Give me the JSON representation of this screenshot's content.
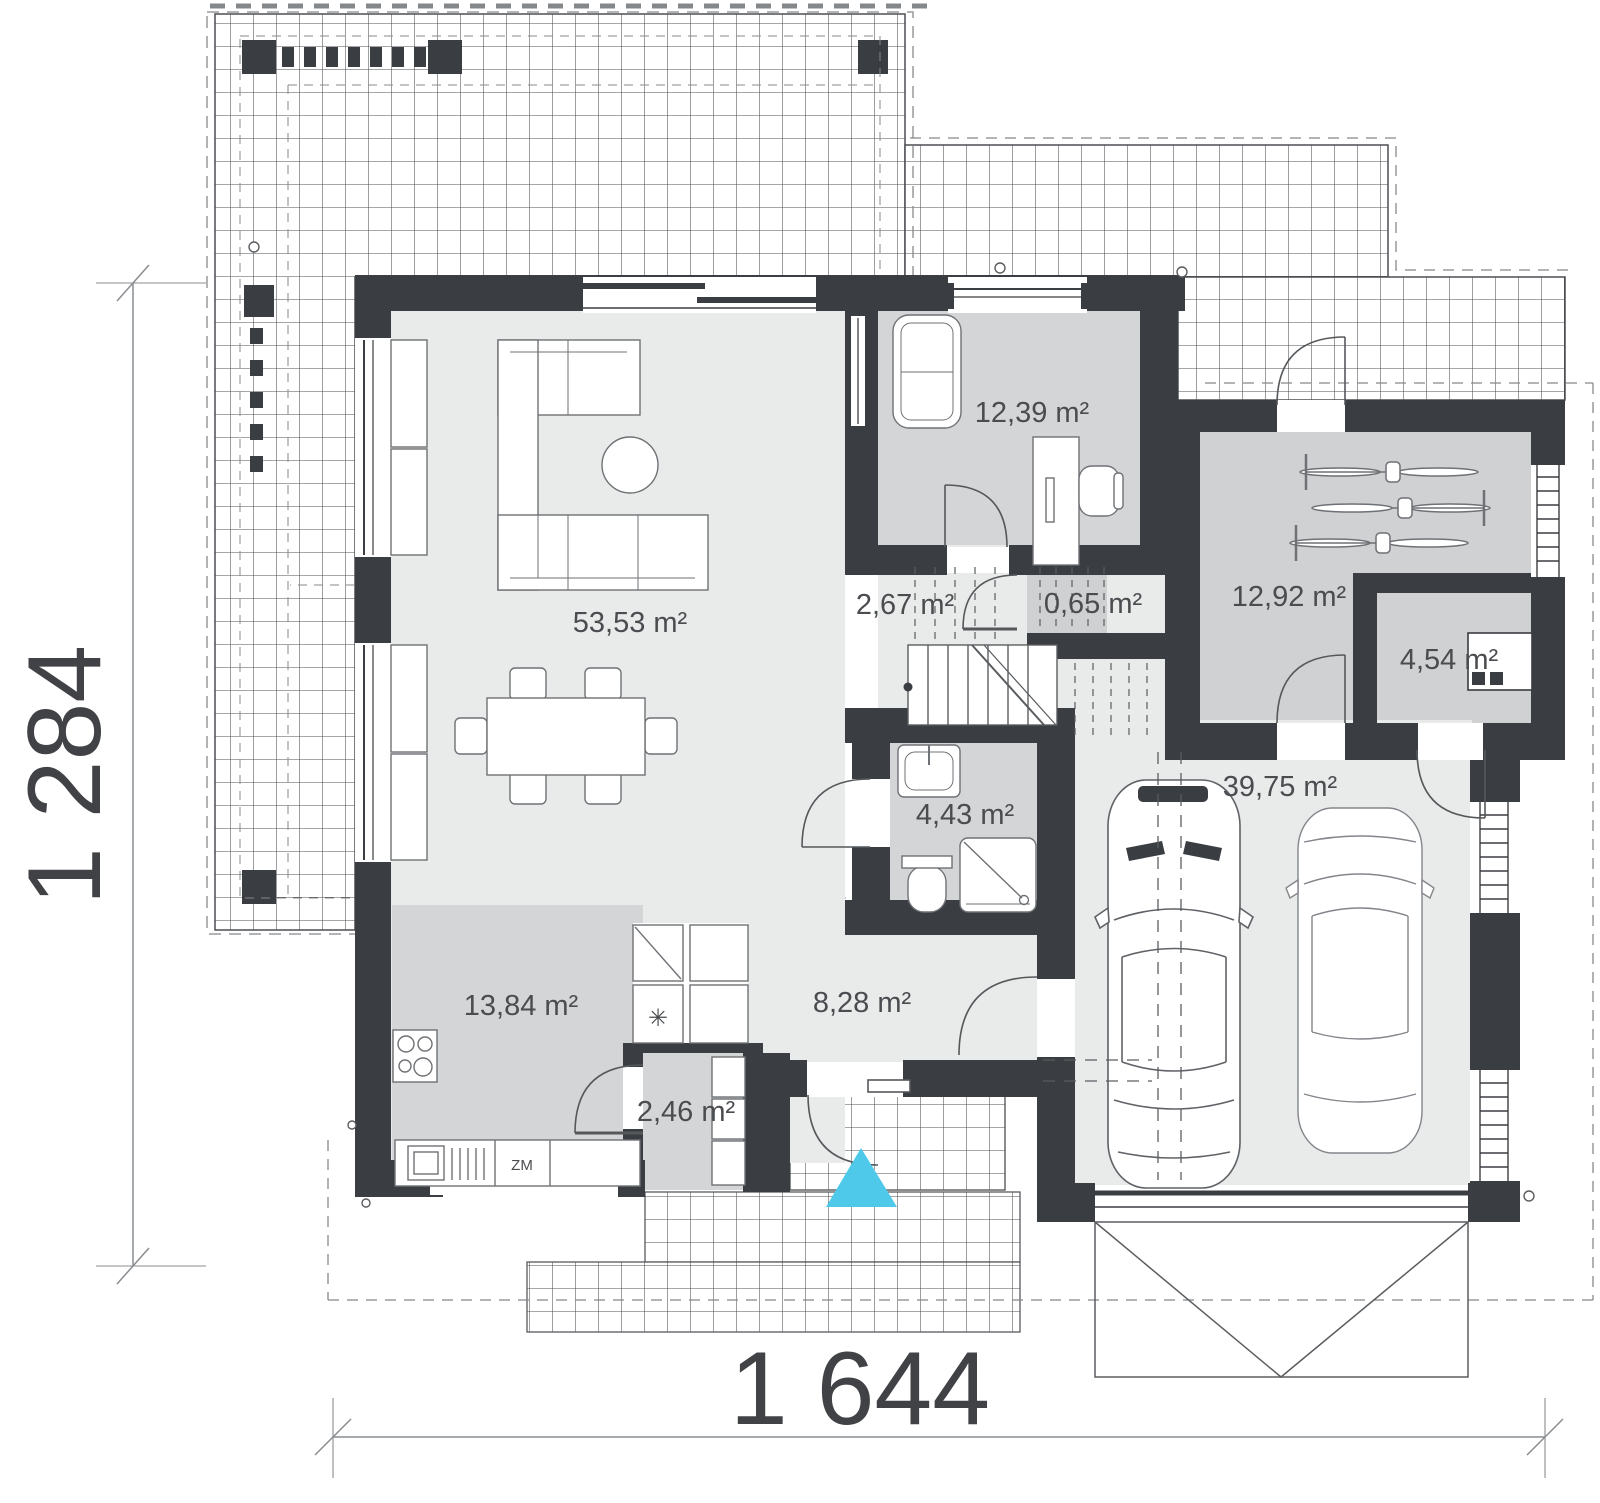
{
  "plan_title": "parter / ground floor plan",
  "rooms": {
    "living": {
      "label": "53,53 m²"
    },
    "office": {
      "label": "12,39 m²"
    },
    "hall": {
      "label": "2,67 m²"
    },
    "closet": {
      "label": "0,65 m²"
    },
    "utility": {
      "label": "12,92 m²"
    },
    "storage": {
      "label": "4,54 m²"
    },
    "bathroom": {
      "label": "4,43 m²"
    },
    "garage": {
      "label": "39,75 m²"
    },
    "kitchen": {
      "label": "13,84 m²"
    },
    "hallway": {
      "label": "8,28 m²"
    },
    "pantry": {
      "label": "2,46 m²"
    }
  },
  "dimensions": {
    "total_width": "1 644",
    "total_height": "1 284"
  },
  "appliances": {
    "dishwasher": "ZM",
    "freezer_symbol": "✳"
  },
  "colors": {
    "wall": "#3a3d41",
    "room_light": "#e9eaea",
    "room_medium": "#d4d5d6",
    "entrance_marker": "#4ec9e9",
    "line": "#5a5d60",
    "grid_line": "#4b4e52"
  }
}
